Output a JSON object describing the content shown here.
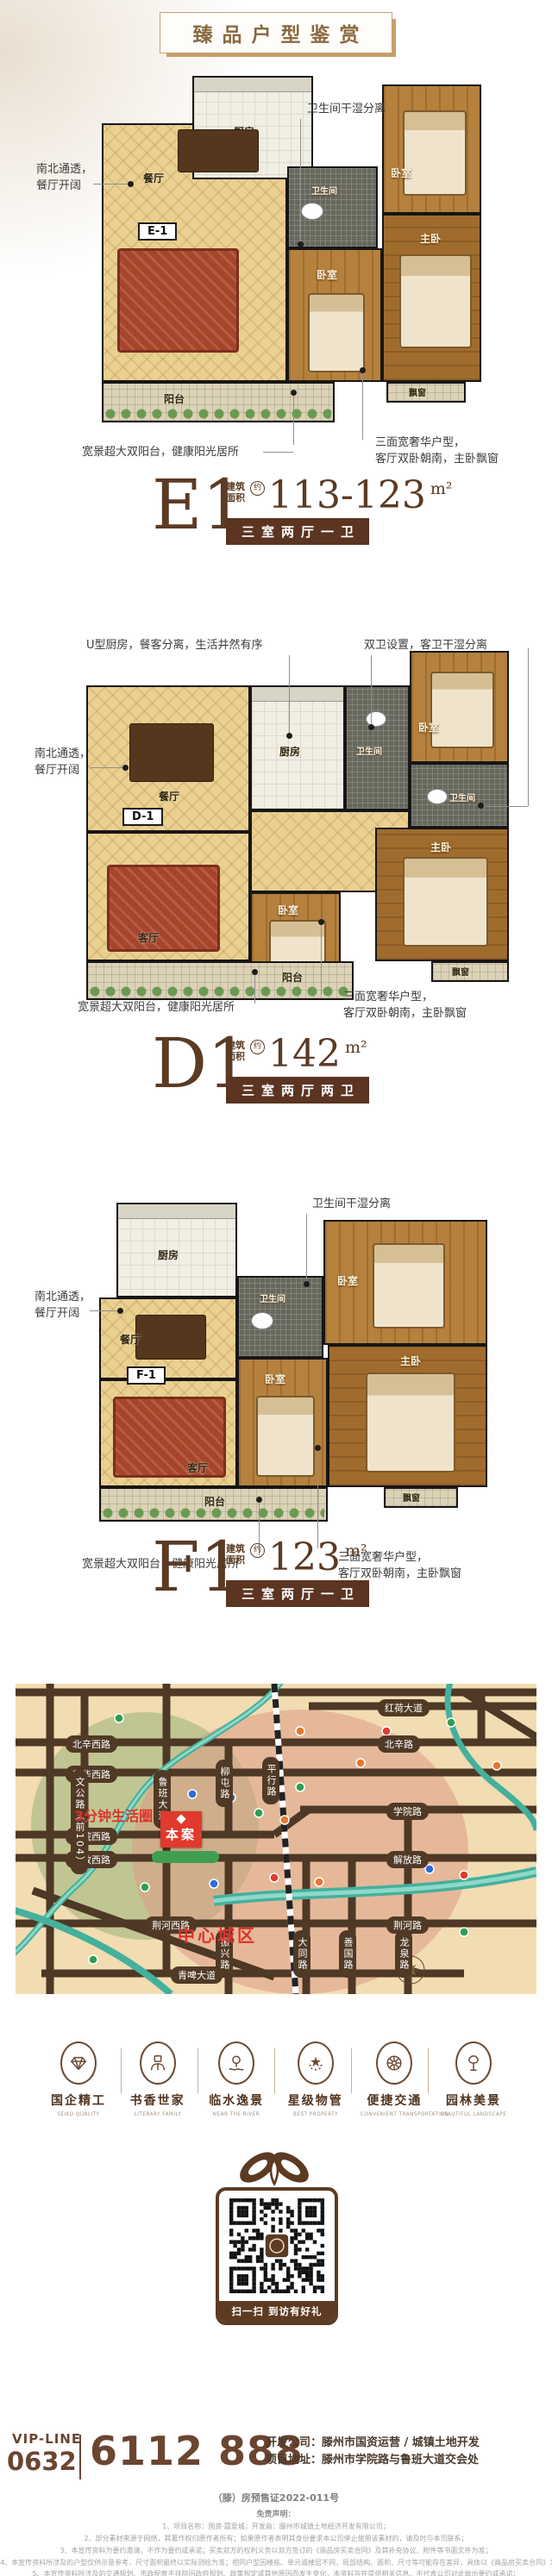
{
  "banner": {
    "title": "臻品户型鉴赏"
  },
  "colors": {
    "accent_brown": "#5b3422",
    "accent_red": "#e03a2d",
    "map_bg": "#f2dcb2",
    "road": "#4e3826"
  },
  "rooms": {
    "kitchen": "厨房",
    "bath": "卫生间",
    "bedroom": "卧室",
    "master": "主卧",
    "living": "客厅",
    "dining": "餐厅",
    "balcony": "阳台",
    "bay_window": "飘窗"
  },
  "plans_common": {
    "area_prefix": "建筑面积",
    "approx": "约",
    "unit": "m²"
  },
  "plans": [
    {
      "id": "E1",
      "badge": "E-1",
      "area": "113-123",
      "spec": "三室两厅一卫",
      "callout_top": "卫生间干湿分离",
      "callout_left": "南北通透，\n餐厅开阔",
      "callout_bottom_left": "宽景超大双阳台，健康阳光居所",
      "callout_bottom_right": "三面宽奢华户型，\n客厅双卧朝南，主卧飘窗"
    },
    {
      "id": "D1",
      "badge": "D-1",
      "area": "142",
      "spec": "三室两厅两卫",
      "callout_top_left": "U型厨房，餐客分离，生活井然有序",
      "callout_top_right": "双卫设置，客卫干湿分离",
      "callout_left": "南北通透，\n餐厅开阔",
      "callout_bottom_left": "宽景超大双阳台，健康阳光居所",
      "callout_bottom_right": "三面宽奢华户型，\n客厅双卧朝南，主卧飘窗"
    },
    {
      "id": "F1",
      "badge": "F-1",
      "area": "123",
      "spec": "三室两厅一卫",
      "callout_top": "卫生间干湿分离",
      "callout_left": "南北通透，\n餐厅开阔",
      "callout_bottom_left": "宽景超大双阳台，健康阳光居所",
      "callout_bottom_right": "三面宽奢华户型，\n客厅双卧朝南，主卧飘窗"
    }
  ],
  "map": {
    "life_circle_label": "3分钟生活圈",
    "center_label": "中心城区",
    "site_label": "本案",
    "roads_h": [
      "红荷大道",
      "北辛西路",
      "北辛路",
      "新华西路",
      "学院西路",
      "学院路",
      "解放西路",
      "解放路",
      "荆河西路",
      "荆河路",
      "青啤大道"
    ],
    "roads_v": [
      "文公路（前104）",
      "鲁班大道",
      "柳屯路",
      "平行路",
      "振兴路",
      "大同路",
      "善国路",
      "龙泉路"
    ]
  },
  "features": [
    {
      "label": "国企精工",
      "sub": "SEIKO QUALITY"
    },
    {
      "label": "书香世家",
      "sub": "LITERARY FAMILY"
    },
    {
      "label": "临水逸景",
      "sub": "NEAR THE RIVER"
    },
    {
      "label": "星级物管",
      "sub": "BEST PROPERTY"
    },
    {
      "label": "便捷交通",
      "sub": "CONVENIENT TRANSPORTATION"
    },
    {
      "label": "园林美景",
      "sub": "BEAUTIFUL LANDSCAPE"
    }
  ],
  "qr": {
    "caption": "扫一扫 到访有好礼"
  },
  "contact": {
    "vip_label": "VIP-LINE",
    "area_code": "0632",
    "phone": "6112 888",
    "developer": "开发公司：滕州市国资运营 / 城镇土地开发",
    "address": "项目地址：滕州市学院路与鲁班大道交会处"
  },
  "disclaimer": {
    "permit": "（滕）房预售证2022-011号",
    "heading": "免责声明：",
    "items": [
      "1、项目名称：国资·囍爱城；开发商：滕州市城镇土地经济开发有限公司；",
      "2、部分素材来源于网络，其著作权归原作者所有；如果原作者表明其身份要求本公司停止使用该素材的，请及时与本司联系；",
      "3、本宣传资料为要约邀请，不作为要约或承诺；买卖双方的权利义务以双方签订的《商品房买卖合同》及其补充协议、附件等书面文件为准；",
      "4、本宣传资料所涉及的户型仅供示意参考，尺寸面积最终以实际测绘为准；相同户型因楼栋、单元或楼层不同，局部结构、面积、尺寸等可能存在差异，具体以《商品房买卖合同》为准；",
      "5、本宣传资料所涉及的交通规划、市政配套不排除因政府规划、政策规定或其他原因而发生变化，本资料旨在提供相关信息，不代表公司对此做出要约或承诺；"
    ]
  }
}
